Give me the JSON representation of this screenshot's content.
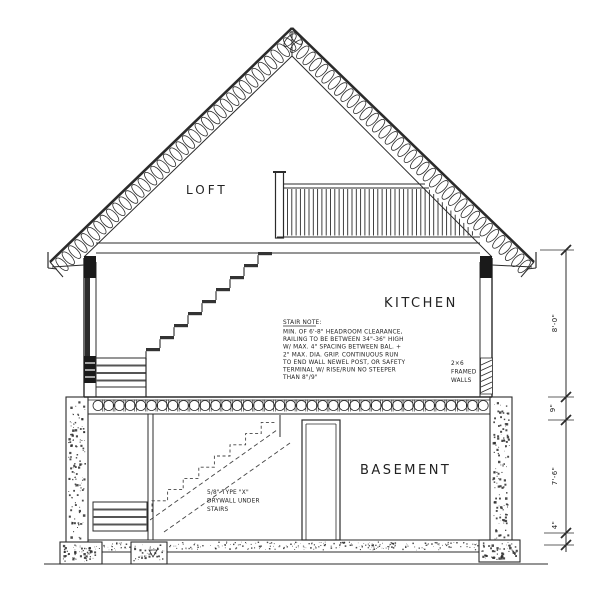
{
  "labels": {
    "loft": "LOFT",
    "kitchen": "KITCHEN",
    "basement": "BASEMENT"
  },
  "stair_note": {
    "title": "STAIR NOTE:",
    "lines": [
      "MIN. OF 6'-8\" HEADROOM CLEARANCE,",
      "RAILING TO BE BETWEEN 34\"-36\" HIGH",
      "W/ MAX. 4\" SPACING BETWEEN BAL. +",
      "2\" MAX. DIA. GRIP. CONTINUOUS RUN",
      "TO END WALL NEWEL POST, OR SAFETY",
      "TERMINAL W/ RISE/RUN NO STEEPER",
      "THAN 8\"/9\""
    ]
  },
  "wall_note": {
    "line1": "2×6",
    "line2": "FRAMED",
    "line3": "WALLS"
  },
  "drywall_note": {
    "line1": "5/8\" TYPE \"X\"",
    "line2": "DRYWALL UNDER",
    "line3": "STAIRS"
  },
  "dimensions": {
    "main_floor_height": "8'-0\"",
    "floor_structure": "9\"",
    "basement_height": "7'-6\"",
    "slab_thickness": "4\""
  },
  "colors": {
    "ink": "#2b2b2b",
    "background": "#ffffff"
  }
}
